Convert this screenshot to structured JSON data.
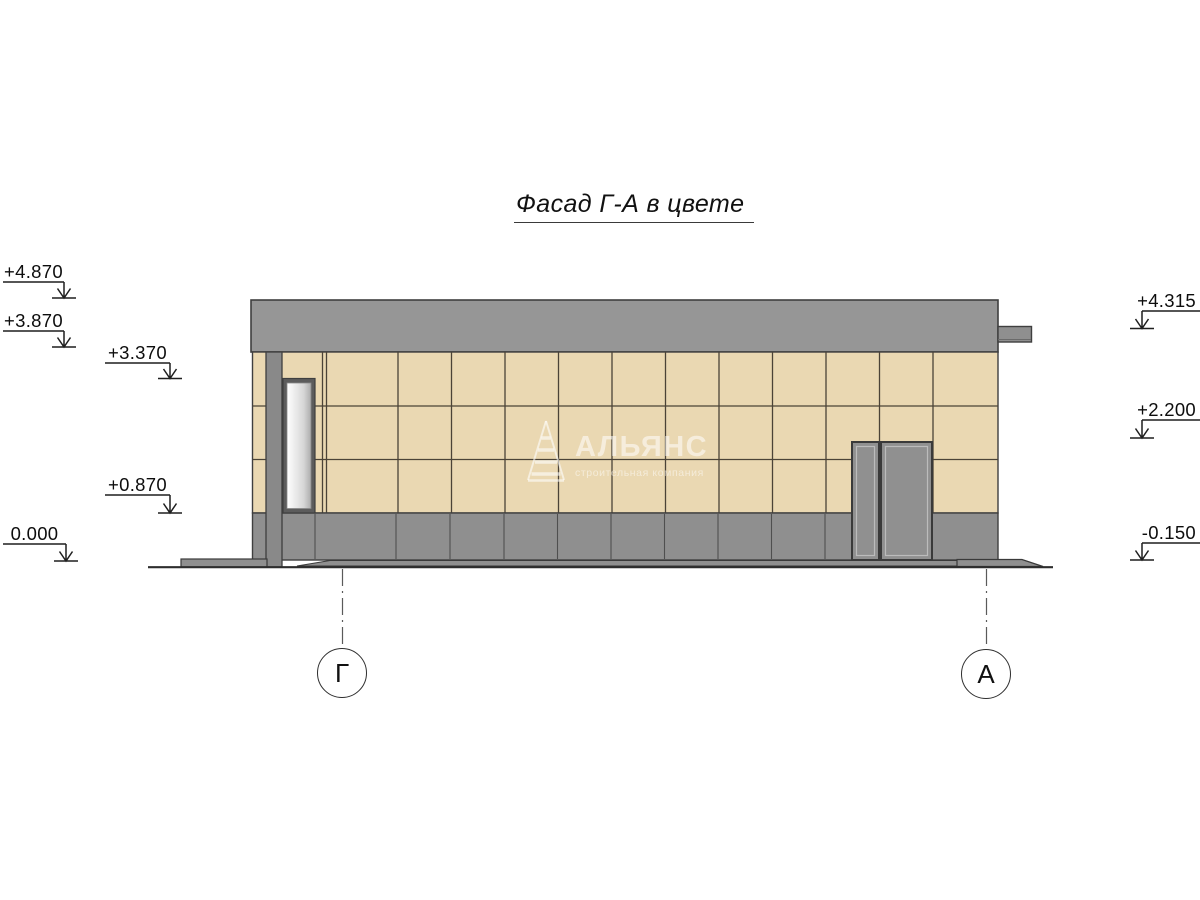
{
  "title": {
    "text": "Фасад Г-А в цвете"
  },
  "watermark": {
    "name": "АЛЬЯНС",
    "subtitle": "строительная компания",
    "logo": "pyramid-icon"
  },
  "elevations": {
    "left": [
      {
        "label": "+4.870"
      },
      {
        "label": "+3.870"
      },
      {
        "label": "+3.370"
      },
      {
        "label": "+0.870"
      },
      {
        "label": "0.000"
      }
    ],
    "right": [
      {
        "label": "+4.315"
      },
      {
        "label": "+2.200"
      },
      {
        "label": "-0.150"
      }
    ]
  },
  "axes": [
    {
      "label": "Г"
    },
    {
      "label": "А"
    }
  ],
  "colors": {
    "background": "#ffffff",
    "facade_tile": "#ead8b2",
    "panel_gray": "#969696",
    "base_gray": "#8f8f8f",
    "column_gray": "#898989",
    "door_gray": "#909090",
    "joint_dark": "#4b4337",
    "outline": "#3f3f3f"
  }
}
